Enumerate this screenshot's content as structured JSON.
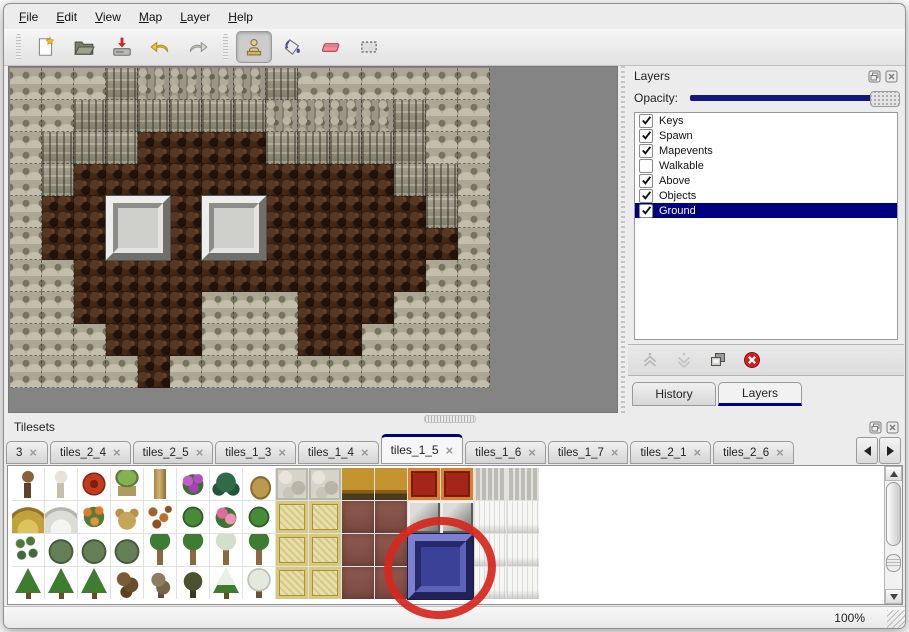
{
  "menu": {
    "items": [
      {
        "label": "File"
      },
      {
        "label": "Edit"
      },
      {
        "label": "View"
      },
      {
        "label": "Map"
      },
      {
        "label": "Layer"
      },
      {
        "label": "Help"
      }
    ]
  },
  "toolbar": {
    "groups": [
      {
        "buttons": [
          {
            "name": "new",
            "icon": "new-file-icon",
            "active": false
          },
          {
            "name": "open",
            "icon": "open-folder-icon",
            "active": false
          },
          {
            "name": "save",
            "icon": "save-icon",
            "active": false
          },
          {
            "name": "undo",
            "icon": "undo-icon",
            "active": false
          },
          {
            "name": "redo",
            "icon": "redo-icon",
            "active": false
          }
        ]
      },
      {
        "buttons": [
          {
            "name": "stamp",
            "icon": "stamp-tool-icon",
            "active": true
          },
          {
            "name": "fill",
            "icon": "fill-tool-icon",
            "active": false
          },
          {
            "name": "eraser",
            "icon": "eraser-tool-icon",
            "active": false
          },
          {
            "name": "select",
            "icon": "select-tool-icon",
            "active": false
          }
        ]
      }
    ]
  },
  "layers_panel": {
    "title": "Layers",
    "opacity_label": "Opacity:",
    "opacity_fraction": 1.0,
    "layers": [
      {
        "name": "Keys",
        "checked": true,
        "selected": false
      },
      {
        "name": "Spawn",
        "checked": true,
        "selected": false
      },
      {
        "name": "Mapevents",
        "checked": true,
        "selected": false
      },
      {
        "name": "Walkable",
        "checked": false,
        "selected": false
      },
      {
        "name": "Above",
        "checked": true,
        "selected": false
      },
      {
        "name": "Objects",
        "checked": true,
        "selected": false
      },
      {
        "name": "Ground",
        "checked": true,
        "selected": true
      }
    ],
    "tabs": [
      {
        "label": "History",
        "active": false
      },
      {
        "label": "Layers",
        "active": true
      }
    ]
  },
  "tilesets_panel": {
    "title": "Tilesets",
    "tabs": [
      {
        "label": "3",
        "active": false
      },
      {
        "label": "tiles_2_4",
        "active": false
      },
      {
        "label": "tiles_2_5",
        "active": false
      },
      {
        "label": "tiles_1_3",
        "active": false
      },
      {
        "label": "tiles_1_4",
        "active": false
      },
      {
        "label": "tiles_1_5",
        "active": true
      },
      {
        "label": "tiles_1_6",
        "active": false
      },
      {
        "label": "tiles_1_7",
        "active": false
      },
      {
        "label": "tiles_2_1",
        "active": false
      },
      {
        "label": "tiles_2_6",
        "active": false
      }
    ]
  },
  "status_bar": {
    "zoom": "100%"
  },
  "map": {
    "tile_size": 32,
    "legend": {
      "S": "stone-scale-wall",
      "C": "cliff-face",
      "T": "cliff-top-rock",
      "F": "dark-floor"
    },
    "rows": [
      "SSSCTTTTCSSSSSS",
      "SSCCCCCCTTTTCSS",
      "SCCCFFFFCCCCCSS",
      "SCFFFFFFFFFFCCS",
      "SFFFFFFFFFFFFCS",
      "SFFFFFFFFFFFFFS",
      "SSFFFFFFFFFFFSS",
      "SSFFFFSSSFFFSSS",
      "SSSFFFSSSFFSSSS",
      "SSSSFSSSSSSSSSS"
    ],
    "blocks": [
      {
        "col": 3,
        "row": 4,
        "span": 2
      },
      {
        "col": 6,
        "row": 4,
        "span": 2
      }
    ]
  },
  "tileset": {
    "tile_size": 32,
    "rows": [
      [
        "trunk",
        "whitetree",
        "redbloom",
        "stump",
        "trunk2",
        "purplebloom",
        "fern",
        "drywood",
        "stone",
        "stone",
        "woodtop",
        "woodtop",
        "redrug",
        "redrug",
        "graycloth",
        "graycloth"
      ],
      [
        "hay",
        "snowpile",
        "orangebloom",
        "dryplant",
        "leaves",
        "lilypad",
        "pinkbloom",
        "lilypad",
        "mat",
        "mat",
        "mauve",
        "mauve",
        "grayblock",
        "grayblock",
        "whitecurtain",
        "whitecurtain"
      ],
      [
        "sprigs",
        "bush",
        "bush",
        "bush",
        "palm",
        "palm",
        "snowpalm",
        "palm",
        "mat",
        "mat",
        "mauve",
        "mauve",
        "white",
        "white",
        "whitecurtain",
        "whitecurtain"
      ],
      [
        "pine",
        "pine",
        "pine",
        "twisted",
        "deadtree",
        "darktree",
        "snowpine",
        "snowtree",
        "mat",
        "mat",
        "mauve",
        "mauve",
        "white",
        "white",
        "whitecurtain",
        "whitecurtain"
      ]
    ],
    "highlight_block": {
      "col": 12,
      "row": 2,
      "span": 2
    }
  },
  "annotation": {
    "type": "ellipse",
    "color": "#d6281e"
  },
  "colors": {
    "accent_navy": "#000080",
    "selection_bg": "#000080",
    "map_void": "#848484",
    "annotation_red": "#d6281e"
  }
}
